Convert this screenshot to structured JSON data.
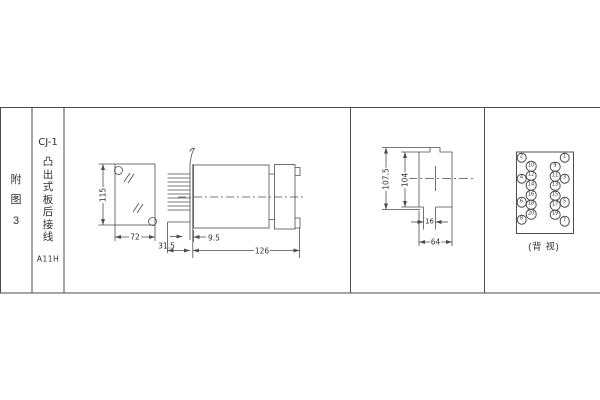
{
  "page": {
    "bg": "#ffffff",
    "line_color": "#4d4d4d",
    "text_color": "#2f2f2f"
  },
  "index_column": {
    "chars": [
      "附",
      "图",
      "3"
    ]
  },
  "title_column": {
    "model": "CJ-1",
    "name_chars": [
      "凸",
      "出",
      "式",
      "板",
      "后",
      "接",
      "线"
    ],
    "code": "A11H"
  },
  "front_view": {
    "height_dim": "115",
    "width_dim": "72"
  },
  "side_view": {
    "pin_depth_dim": "31.5",
    "panel_offset_dim": "9.5",
    "length_dim": "126"
  },
  "rear_cutout_view": {
    "outer_height_dim": "107.5",
    "inner_height_dim": "104",
    "slot_width_dim": "16",
    "width_dim": "64"
  },
  "back_view": {
    "caption": "(背 视)",
    "terminals": [
      {
        "n": "2",
        "x": 521.5,
        "y": 157.5
      },
      {
        "n": "1",
        "x": 564.5,
        "y": 157.5
      },
      {
        "n": "10",
        "x": 531,
        "y": 166
      },
      {
        "n": "9",
        "x": 555,
        "y": 166.5
      },
      {
        "n": "12",
        "x": 531,
        "y": 175.5
      },
      {
        "n": "11",
        "x": 555,
        "y": 176
      },
      {
        "n": "4",
        "x": 521.5,
        "y": 178.5
      },
      {
        "n": "3",
        "x": 564.5,
        "y": 178.5
      },
      {
        "n": "14",
        "x": 531,
        "y": 185
      },
      {
        "n": "13",
        "x": 555,
        "y": 185.5
      },
      {
        "n": "16",
        "x": 531,
        "y": 195
      },
      {
        "n": "15",
        "x": 555,
        "y": 195.5
      },
      {
        "n": "6",
        "x": 521.5,
        "y": 202
      },
      {
        "n": "5",
        "x": 564.5,
        "y": 202
      },
      {
        "n": "18",
        "x": 531,
        "y": 204.5
      },
      {
        "n": "17",
        "x": 555,
        "y": 205
      },
      {
        "n": "20",
        "x": 531,
        "y": 214
      },
      {
        "n": "19",
        "x": 555,
        "y": 214.5
      },
      {
        "n": "8",
        "x": 521.5,
        "y": 219.5
      },
      {
        "n": "7",
        "x": 564.5,
        "y": 221
      }
    ]
  }
}
